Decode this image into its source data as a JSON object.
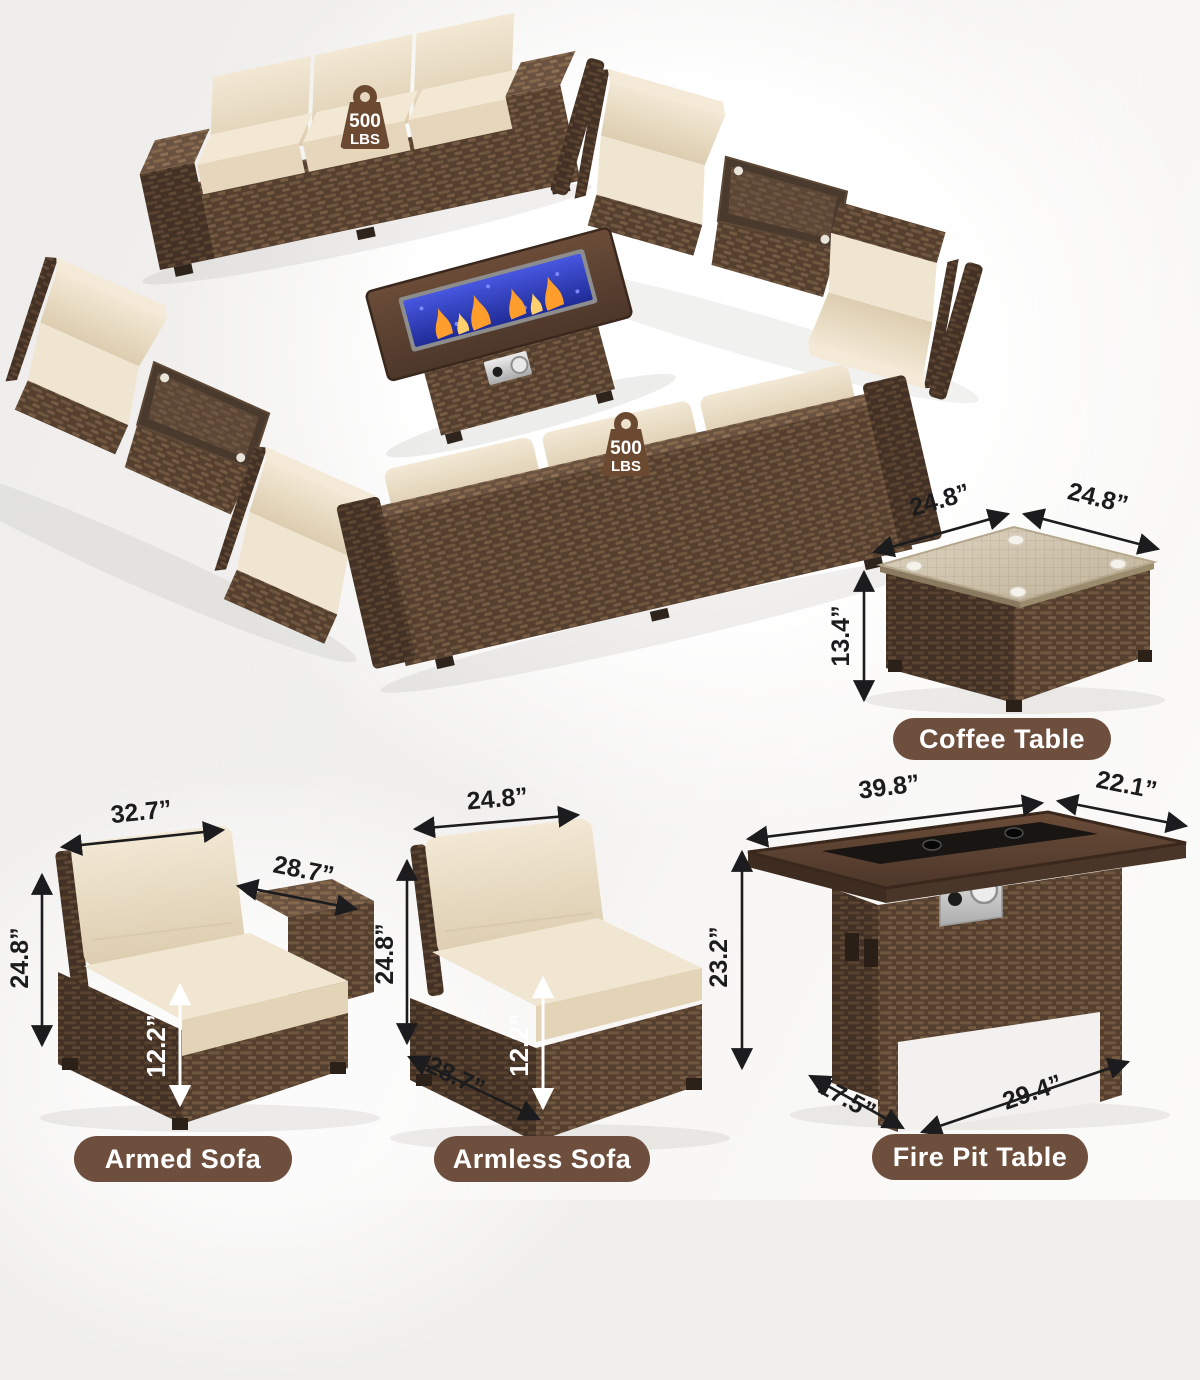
{
  "scene": {
    "weight_capacity_badge": {
      "icon": "kettlebell-weight-icon",
      "value": "500",
      "unit": "LBS"
    }
  },
  "products": {
    "coffee_table": {
      "label": "Coffee Table",
      "dims": {
        "top_width": "24.8”",
        "top_depth": "24.8”",
        "height": "13.4”"
      }
    },
    "armed_sofa": {
      "label": "Armed Sofa",
      "dims": {
        "back_width": "32.7”",
        "depth": "28.7”",
        "height": "24.8”",
        "seat_height": "12.2”"
      }
    },
    "armless_sofa": {
      "label": "Armless Sofa",
      "dims": {
        "back_width": "24.8”",
        "height": "24.8”",
        "seat_height": "12.2”",
        "depth": "28.7”"
      }
    },
    "fire_pit_table": {
      "label": "Fire Pit Table",
      "dims": {
        "top_width": "39.8”",
        "top_depth": "22.1”",
        "height": "23.2”",
        "base_depth": "17.5”",
        "base_width": "29.4”"
      }
    }
  },
  "colors": {
    "background": "#f0efed",
    "label_pill": "#6e4f3e",
    "badge": "#6b4a31",
    "wicker_brown": "#5a4433",
    "cushion_beige": "#ece0c9",
    "fire_glass_blue": "#2f3fc0",
    "flame_orange": "#ff9e2d",
    "dimension_text": "#1c1c1e"
  }
}
